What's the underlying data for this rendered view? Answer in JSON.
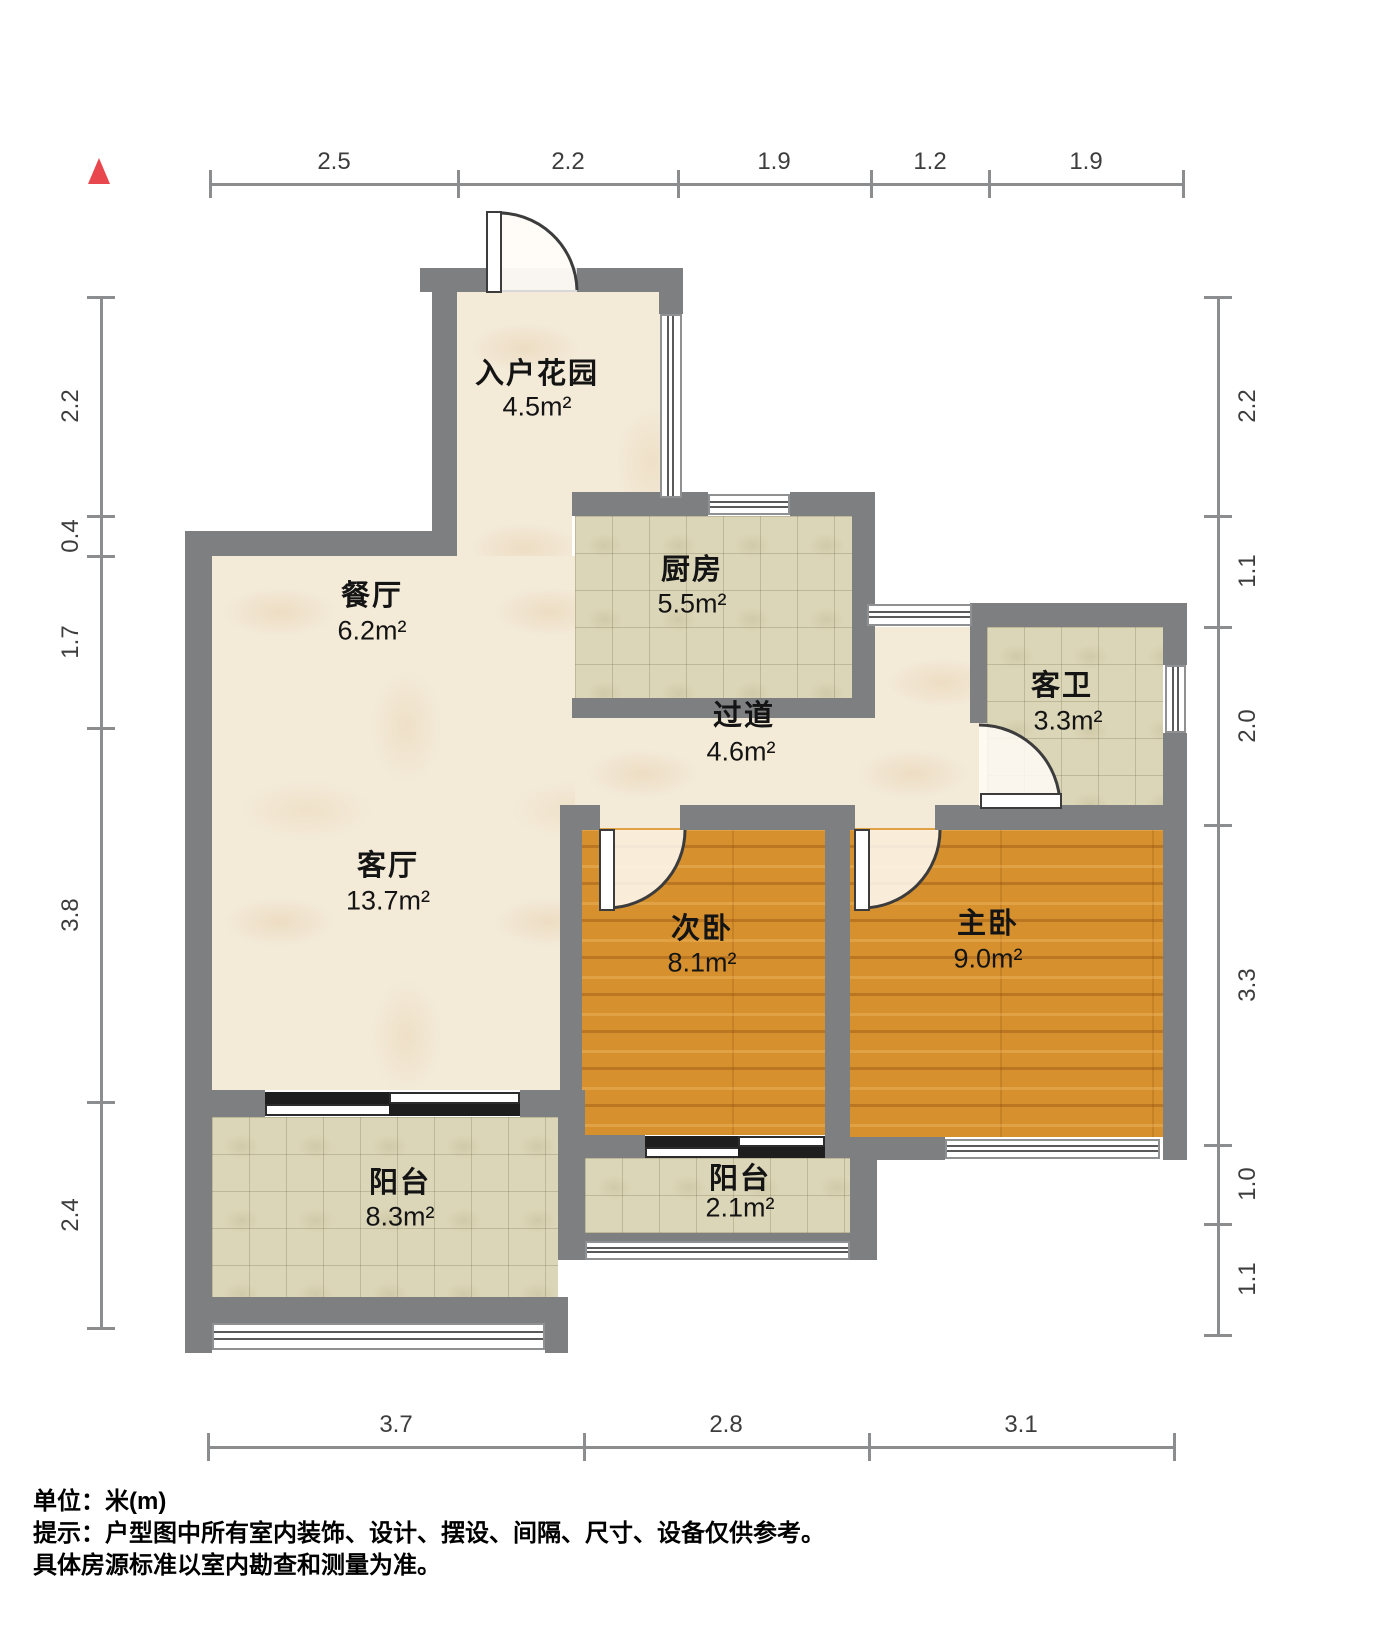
{
  "unit_scale": "100px-per-meter",
  "colors": {
    "wall": "#7e7f80",
    "marble_floor": "#f3ead8",
    "tile_floor": "#dcd6b8",
    "wood_floor": "#d6912e",
    "north_arrow": "#e8484d",
    "dim_line": "#8c8d8e",
    "text": "#141414"
  },
  "rooms": [
    {
      "id": "entry-garden",
      "name": "入户花园",
      "area": "4.5m²",
      "nx": 537,
      "ny": 371,
      "ax": 537,
      "ay": 407
    },
    {
      "id": "dining",
      "name": "餐厅",
      "area": "6.2m²",
      "nx": 372,
      "ny": 593,
      "ax": 372,
      "ay": 631
    },
    {
      "id": "kitchen",
      "name": "厨房",
      "area": "5.5m²",
      "nx": 692,
      "ny": 567,
      "ax": 692,
      "ay": 604
    },
    {
      "id": "guest-bath",
      "name": "客卫",
      "area": "3.3m²",
      "nx": 1062,
      "ny": 683,
      "ax": 1068,
      "ay": 721
    },
    {
      "id": "hallway",
      "name": "过道",
      "area": "4.6m²",
      "nx": 744,
      "ny": 713,
      "ax": 741,
      "ay": 752
    },
    {
      "id": "living",
      "name": "客厅",
      "area": "13.7m²",
      "nx": 388,
      "ny": 863,
      "ax": 388,
      "ay": 901
    },
    {
      "id": "bedroom2",
      "name": "次卧",
      "area": "8.1m²",
      "nx": 702,
      "ny": 926,
      "ax": 702,
      "ay": 963
    },
    {
      "id": "master",
      "name": "主卧",
      "area": "9.0m²",
      "nx": 988,
      "ny": 921,
      "ax": 988,
      "ay": 959
    },
    {
      "id": "balcony-large",
      "name": "阳台",
      "area": "8.3m²",
      "nx": 400,
      "ny": 1180,
      "ax": 400,
      "ay": 1217
    },
    {
      "id": "balcony-small",
      "name": "阳台",
      "area": "2.1m²",
      "nx": 740,
      "ny": 1176,
      "ax": 740,
      "ay": 1208
    }
  ],
  "dimensions": {
    "top": {
      "axis": "h",
      "line": 184,
      "ticks": [
        210,
        458,
        678,
        871,
        989,
        1183
      ],
      "labels": [
        {
          "t": "2.5",
          "p": 334
        },
        {
          "t": "2.2",
          "p": 568
        },
        {
          "t": "1.9",
          "p": 774
        },
        {
          "t": "1.2",
          "p": 930
        },
        {
          "t": "1.9",
          "p": 1086
        }
      ]
    },
    "bottom": {
      "axis": "h",
      "line": 1447,
      "ticks": [
        208,
        584,
        869,
        1174
      ],
      "labels": [
        {
          "t": "3.7",
          "p": 396
        },
        {
          "t": "2.8",
          "p": 726
        },
        {
          "t": "3.1",
          "p": 1021
        }
      ]
    },
    "left": {
      "axis": "v",
      "line": 101,
      "ticks": [
        297,
        516,
        556,
        728,
        1102,
        1328
      ],
      "labels": [
        {
          "t": "2.2",
          "p": 406
        },
        {
          "t": "0.4",
          "p": 536
        },
        {
          "t": "1.7",
          "p": 642
        },
        {
          "t": "3.8",
          "p": 915
        },
        {
          "t": "2.4",
          "p": 1215
        }
      ]
    },
    "right": {
      "axis": "v",
      "line": 1218,
      "ticks": [
        297,
        516,
        627,
        825,
        1145,
        1224,
        1335
      ],
      "labels": [
        {
          "t": "2.2",
          "p": 406
        },
        {
          "t": "1.1",
          "p": 571
        },
        {
          "t": "2.0",
          "p": 726
        },
        {
          "t": "3.3",
          "p": 985
        },
        {
          "t": "1.0",
          "p": 1184
        },
        {
          "t": "1.1",
          "p": 1279
        }
      ]
    }
  },
  "notes": {
    "unit": "单位：米(m)",
    "line1": "提示：户型图中所有室内装饰、设计、摆设、间隔、尺寸、设备仅供参考。",
    "line2": "具体房源标准以室内勘查和测量为准。"
  },
  "geometry": {
    "floors": [
      {
        "id": "entry-garden",
        "k": "marble",
        "x": 457,
        "y": 292,
        "w": 203,
        "h": 200
      },
      {
        "id": "garden-dining-link",
        "k": "marble",
        "x": 457,
        "y": 492,
        "w": 115,
        "h": 64
      },
      {
        "id": "living-dining",
        "k": "marble",
        "x": 212,
        "y": 556,
        "w": 363,
        "h": 534
      },
      {
        "id": "hallway",
        "k": "marble",
        "x": 575,
        "y": 718,
        "w": 395,
        "h": 87
      },
      {
        "id": "hallway-upper",
        "k": "marble",
        "x": 875,
        "y": 627,
        "w": 95,
        "h": 91
      },
      {
        "id": "bath-door-opening",
        "k": "marble",
        "x": 970,
        "y": 718,
        "w": 17,
        "h": 88
      },
      {
        "id": "bedroom2-door-opening",
        "k": "marble",
        "x": 600,
        "y": 805,
        "w": 80,
        "h": 25
      },
      {
        "id": "master-door-opening",
        "k": "marble",
        "x": 855,
        "y": 805,
        "w": 80,
        "h": 25
      },
      {
        "id": "kitchen",
        "k": "tile",
        "x": 575,
        "y": 516,
        "w": 277,
        "h": 182
      },
      {
        "id": "guest-bath",
        "k": "tile",
        "x": 987,
        "y": 627,
        "w": 176,
        "h": 181
      },
      {
        "id": "bedroom2",
        "k": "wood",
        "x": 582,
        "y": 828,
        "w": 243,
        "h": 307
      },
      {
        "id": "master",
        "k": "wood",
        "x": 850,
        "y": 828,
        "w": 313,
        "h": 309
      },
      {
        "id": "balcony-small",
        "k": "tile",
        "x": 585,
        "y": 1158,
        "w": 265,
        "h": 75
      },
      {
        "id": "balcony-large",
        "k": "tile",
        "x": 212,
        "y": 1117,
        "w": 346,
        "h": 180
      }
    ],
    "walls": [
      [
        420,
        268,
        66,
        24
      ],
      [
        577,
        268,
        106,
        24
      ],
      [
        432,
        268,
        25,
        288
      ],
      [
        659,
        268,
        24,
        46
      ],
      [
        659,
        498,
        24,
        18
      ],
      [
        185,
        531,
        272,
        25
      ],
      [
        185,
        531,
        27,
        800
      ],
      [
        572,
        492,
        136,
        24
      ],
      [
        790,
        492,
        85,
        24
      ],
      [
        852,
        492,
        23,
        226
      ],
      [
        572,
        698,
        303,
        20
      ],
      [
        972,
        603,
        215,
        24
      ],
      [
        1163,
        603,
        24,
        62
      ],
      [
        1163,
        733,
        24,
        427
      ],
      [
        970,
        603,
        17,
        120
      ],
      [
        560,
        805,
        40,
        25
      ],
      [
        680,
        805,
        175,
        25
      ],
      [
        935,
        805,
        252,
        25
      ],
      [
        560,
        805,
        22,
        353
      ],
      [
        825,
        805,
        25,
        332
      ],
      [
        582,
        1135,
        63,
        23
      ],
      [
        825,
        1135,
        25,
        23
      ],
      [
        850,
        1137,
        95,
        23
      ],
      [
        850,
        1160,
        27,
        100
      ],
      [
        558,
        1090,
        27,
        170
      ],
      [
        212,
        1090,
        53,
        27
      ],
      [
        520,
        1090,
        40,
        27
      ],
      [
        185,
        1297,
        383,
        26
      ],
      [
        185,
        1323,
        27,
        30
      ],
      [
        545,
        1323,
        23,
        30
      ],
      [
        583,
        1233,
        267,
        9
      ]
    ],
    "sills": [
      [
        486,
        268,
        91,
        24
      ]
    ],
    "windows": [
      {
        "id": "entry-garden-east-window",
        "o": "v",
        "x": 660,
        "y": 314,
        "w": 22,
        "h": 184
      },
      {
        "id": "kitchen-north-window",
        "o": "h",
        "x": 708,
        "y": 494,
        "w": 82,
        "h": 21
      },
      {
        "id": "hallway-north-window",
        "o": "h",
        "x": 867,
        "y": 604,
        "w": 105,
        "h": 22
      },
      {
        "id": "guest-bath-east-window",
        "o": "v",
        "x": 1165,
        "y": 665,
        "w": 21,
        "h": 68
      },
      {
        "id": "master-south-window",
        "o": "h",
        "x": 945,
        "y": 1139,
        "w": 215,
        "h": 20
      },
      {
        "id": "balcony-small-railing",
        "o": "h",
        "x": 585,
        "y": 1241,
        "w": 265,
        "h": 19
      },
      {
        "id": "balcony-large-railing",
        "o": "h",
        "x": 212,
        "y": 1323,
        "w": 333,
        "h": 27
      }
    ],
    "sliding_doors": [
      {
        "id": "living-balcony-slider",
        "c": "dark",
        "x": 265,
        "y": 1092,
        "w": 126,
        "h": 12
      },
      {
        "id": "living-balcony-slider",
        "c": "light",
        "x": 265,
        "y": 1104,
        "w": 126,
        "h": 12
      },
      {
        "id": "living-balcony-slider",
        "c": "light",
        "x": 389,
        "y": 1092,
        "w": 131,
        "h": 12
      },
      {
        "id": "living-balcony-slider",
        "c": "dark",
        "x": 389,
        "y": 1104,
        "w": 131,
        "h": 12
      },
      {
        "id": "bedroom2-balcony-slider",
        "c": "dark",
        "x": 645,
        "y": 1136,
        "w": 95,
        "h": 11
      },
      {
        "id": "bedroom2-balcony-slider",
        "c": "light",
        "x": 645,
        "y": 1147,
        "w": 95,
        "h": 11
      },
      {
        "id": "bedroom2-balcony-slider",
        "c": "light",
        "x": 738,
        "y": 1136,
        "w": 87,
        "h": 11
      },
      {
        "id": "bedroom2-balcony-slider",
        "c": "dark",
        "x": 738,
        "y": 1147,
        "w": 87,
        "h": 11
      }
    ],
    "doors": [
      {
        "id": "entry-door",
        "leaf": [
          487,
          212,
          14,
          80
        ],
        "disc": "M 501 290 L 494 213 A 79 79 0 0 1 577 290 Z",
        "arc": "M 494 213 A 79 79 0 0 1 577 290"
      },
      {
        "id": "guest-bath-door",
        "leaf": [
          981,
          794,
          80,
          14
        ],
        "disc": "M 979 806 L 979 725 A 81 81 0 0 1 1060 806 Z",
        "arc": "M 979 725 A 81 81 0 0 1 1060 806"
      },
      {
        "id": "bedroom2-door",
        "leaf": [
          600,
          830,
          14,
          80
        ],
        "disc": "M 607 830 L 607 908 A 78 78 0 0 0 685 830 Z",
        "arc": "M 607 908 A 78 78 0 0 0 685 830"
      },
      {
        "id": "master-door",
        "leaf": [
          855,
          830,
          14,
          80
        ],
        "disc": "M 862 830 L 862 908 A 78 78 0 0 0 940 830 Z",
        "arc": "M 862 908 A 78 78 0 0 0 940 830"
      }
    ],
    "north_arrow": {
      "x": 88,
      "y": 158,
      "size": 26
    }
  }
}
